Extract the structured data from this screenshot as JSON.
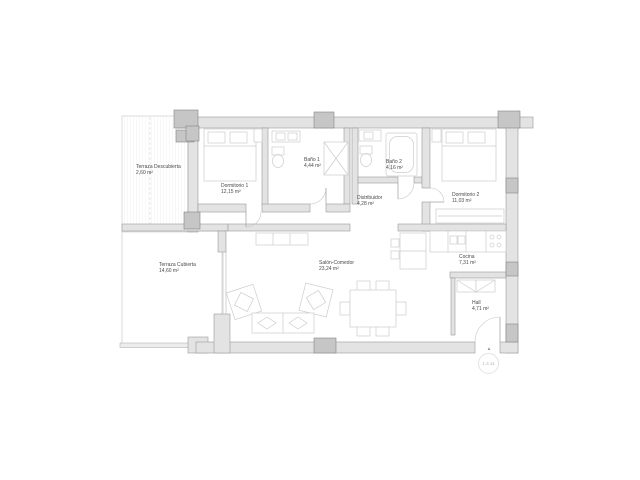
{
  "plan": {
    "rooms": [
      {
        "id": "terraza-descubierta",
        "name": "Terraza Descubierta",
        "area": "2,60 m²"
      },
      {
        "id": "dormitorio-1",
        "name": "Dormitorio 1",
        "area": "12,15 m²"
      },
      {
        "id": "bano-1",
        "name": "Baño 1",
        "area": "4,44 m²"
      },
      {
        "id": "bano-2",
        "name": "Baño 2",
        "area": "4,16 m²"
      },
      {
        "id": "dormitorio-2",
        "name": "Dormitorio 2",
        "area": "11,03 m²"
      },
      {
        "id": "distribuidor",
        "name": "Distribuidor",
        "area": "4,28 m²"
      },
      {
        "id": "terraza-cubierta",
        "name": "Terraza Cubierta",
        "area": "14,60 m²"
      },
      {
        "id": "salon-comedor",
        "name": "Salón-Comedor",
        "area": "23,24 m²"
      },
      {
        "id": "cocina",
        "name": "Cocina",
        "area": "7,31 m²"
      },
      {
        "id": "hall",
        "name": "Hall",
        "area": "4,71 m²"
      }
    ],
    "marker": {
      "label": "1.3.11",
      "icon": "▲"
    },
    "colors": {
      "wall_fill": "#e3e3e3",
      "wall_stroke": "#9a9a9a",
      "pillar_fill": "#c6c6c6",
      "furniture_stroke": "#cccccc",
      "label_text": "#4a4a4a",
      "terrace_line": "#c9c9c9",
      "marker_text": "#b5b5b5",
      "background": "#ffffff"
    }
  }
}
